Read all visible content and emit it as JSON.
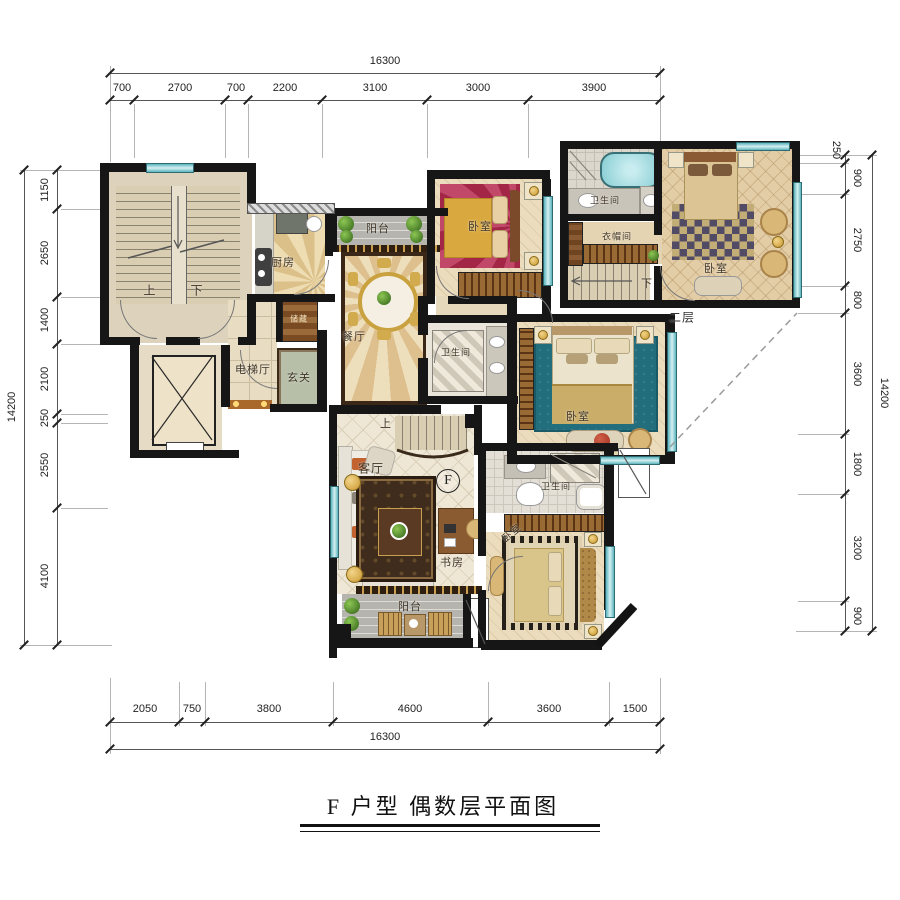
{
  "title": "F 户型 偶数层平面图",
  "unit_marker": "F",
  "floor_note": "二层",
  "stair_labels": {
    "up": "上",
    "down": "下"
  },
  "rooms": {
    "kitchen": "厨房",
    "storage": "储藏",
    "balcony_top": "阳台",
    "bedroom_top": "卧室",
    "dining": "餐厅",
    "elevator_hall": "电梯厅",
    "foyer": "玄关",
    "bath_2f": "卫生间",
    "cloakroom_2f": "衣帽间",
    "bedroom_2f": "卧室",
    "bath_mid": "卫生间",
    "bedroom_master": "卧室",
    "living": "客厅",
    "study": "书房",
    "balcony_bottom": "阳台",
    "bedroom_br": "卧室",
    "bath_br": "卫生间"
  },
  "dimensions": {
    "top": {
      "total": "16300",
      "segments": [
        "700",
        "2700",
        "700",
        "2200",
        "3100",
        "3000",
        "3900"
      ]
    },
    "bottom": {
      "total": "16300",
      "segments": [
        "2050",
        "750",
        "3800",
        "4600",
        "3600",
        "1500"
      ]
    },
    "left": {
      "total": "14200",
      "segments": [
        "1150",
        "2650",
        "1400",
        "2100",
        "250",
        "2550",
        "4100"
      ]
    },
    "right": {
      "total": "14200",
      "segments": [
        "250",
        "900",
        "2750",
        "800",
        "3600",
        "1800",
        "3200",
        "900"
      ]
    }
  },
  "colors": {
    "wall": "#161616",
    "window_teal": "#5cb4bd",
    "floor_beige": "#e8dcc2",
    "rug_teal": "#226e7c",
    "bed_red": "#b23048",
    "accent_gold": "#c9a23f",
    "plant_green": "#5a9e3e"
  }
}
